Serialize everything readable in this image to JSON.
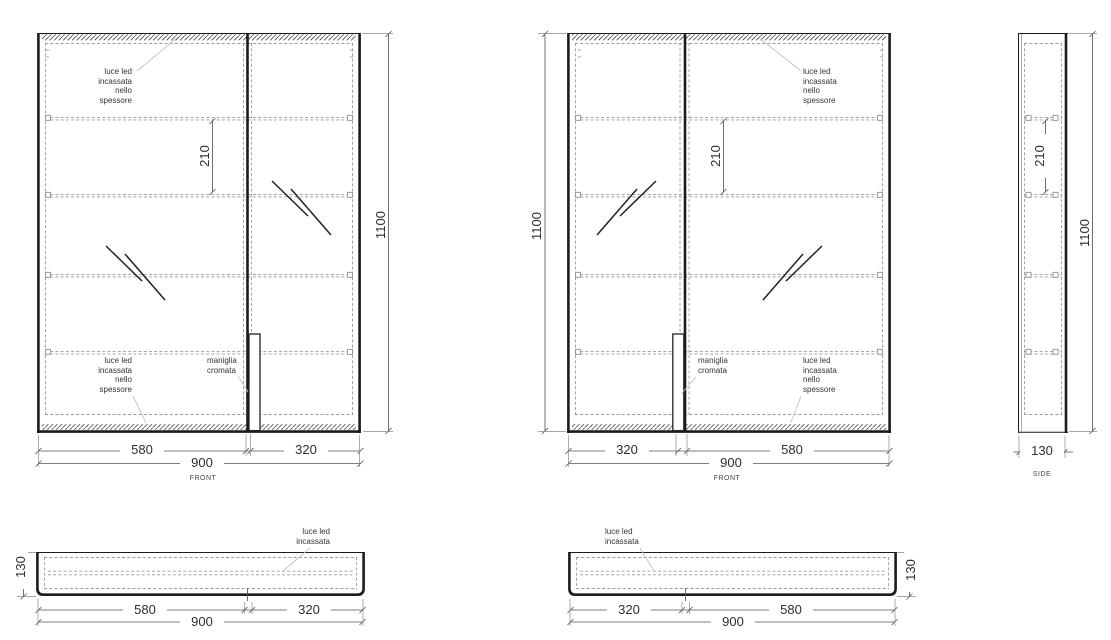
{
  "palette": {
    "line": "#1c1c1c",
    "dashed": "#9b9b9b",
    "dim_line": "#555555",
    "leader": "#c4c4c4",
    "text": "#333333",
    "background": "#ffffff"
  },
  "front_left": {
    "view_label": "FRONT",
    "dim_left_door": "580",
    "dim_right_door": "320",
    "dim_width": "900",
    "dim_height": "1100",
    "dim_shelf_spacing": "210",
    "led_top": "luce led\nincassata\nnello\nspessore",
    "led_bottom": "luce led\nincassata\nnello\nspessore",
    "handle_label": "maniglia\ncromata"
  },
  "front_right": {
    "view_label": "FRONT",
    "dim_left_door": "320",
    "dim_right_door": "580",
    "dim_width": "900",
    "dim_height": "1100",
    "dim_shelf_spacing": "210",
    "led_top": "luce led\nincassata\nnello\nspessore",
    "led_bottom": "luce led\nincassata\nnello\nspessore",
    "handle_label": "maniglia\ncromata"
  },
  "side": {
    "view_label": "SIDE",
    "dim_depth": "130",
    "dim_height": "1100",
    "dim_shelf_spacing": "210"
  },
  "top_left": {
    "dim_left_door": "580",
    "dim_right_door": "320",
    "dim_width": "900",
    "dim_depth": "130",
    "led": "luce led\nincassata"
  },
  "top_right": {
    "dim_left_door": "320",
    "dim_right_door": "580",
    "dim_width": "900",
    "dim_depth": "130",
    "led": "luce led\nincassata"
  }
}
